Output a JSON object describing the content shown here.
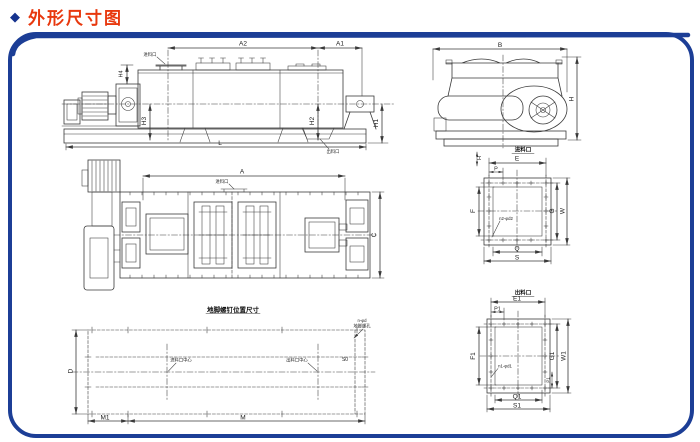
{
  "header": {
    "bullet": "◆",
    "title": "外形尺寸图"
  },
  "colors": {
    "title_red": "#e8380e",
    "frame_blue": "#1c3e96",
    "line": "#3a3a3a"
  },
  "side_view": {
    "labels": {
      "a2": "A2",
      "a1": "A1",
      "l": "L",
      "h1": "H1",
      "h2": "H2",
      "h3": "H3",
      "h4": "H4"
    },
    "ports": {
      "inlet": "进料口",
      "outlet": "出料口"
    }
  },
  "end_view": {
    "labels": {
      "b": "B",
      "h": "H"
    }
  },
  "plan_view": {
    "labels": {
      "a": "A",
      "c": "C"
    },
    "ports": {
      "inlet": "进料口"
    }
  },
  "inlet_flange": {
    "title": "进料口",
    "labels": {
      "h": "H",
      "e": "E",
      "p": "P",
      "f": "F",
      "g": "G",
      "w": "W",
      "q": "Q",
      "s": "S",
      "holes": "n2-φd2"
    }
  },
  "outlet_flange": {
    "title": "出料口",
    "labels": {
      "e1": "E1",
      "p1": "P1",
      "f1": "F1",
      "g1": "G1",
      "w1": "W1",
      "q1": "Q1",
      "s1": "S1",
      "p1_pitch": "P1",
      "holes": "n1-φd1"
    }
  },
  "foundation": {
    "title": "地脚螺钉位置尺寸",
    "labels": {
      "m1": "M1",
      "m": "M",
      "d": "D",
      "s0": "S0",
      "inlet_center": "进料口中心",
      "outlet_center": "出料口中心",
      "holes_line1": "n-φd",
      "holes_line2": "地脚螺孔"
    }
  }
}
